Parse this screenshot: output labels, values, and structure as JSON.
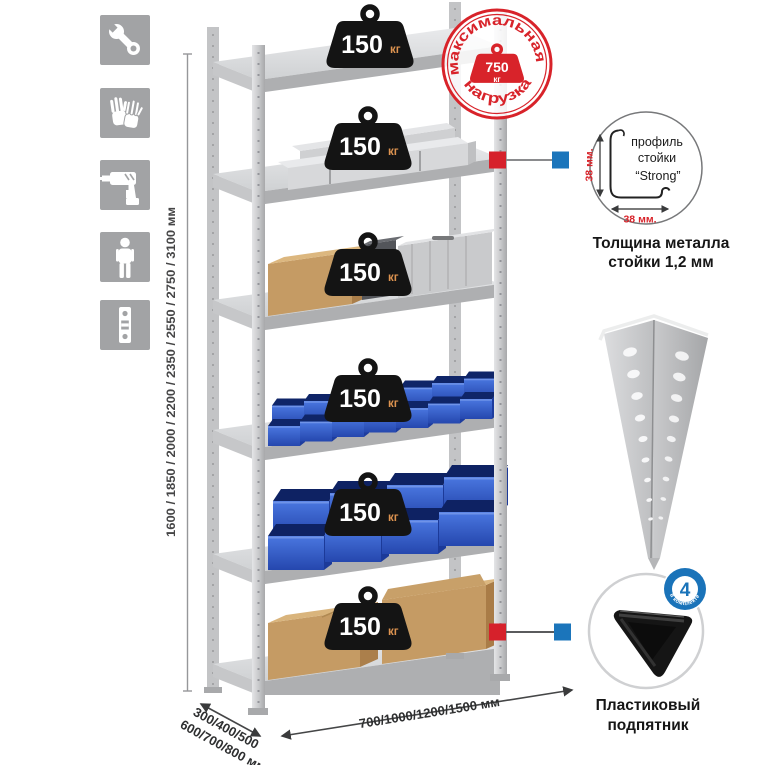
{
  "palette": {
    "accent_red": "#d8232a",
    "accent_blue": "#1b75bb",
    "bin_blue": "#3e6bd6",
    "metal_gray": "#cbccce",
    "weight_black": "#141414",
    "icon_tile_gray": "#a2a3a5",
    "cardboard": "#c59b64"
  },
  "feature_icons": [
    "wrench-icon",
    "gloves-icon",
    "drill-icon",
    "person-icon",
    "level-icon"
  ],
  "dimensions": {
    "height": "1600 / 1850 / 2000 / 2200 / 2350 / 2550 / 2750 / 3100 мм",
    "depth_line1": "300/400/500",
    "depth_line2": "600/700/800 мм",
    "width": "700/1000/1200/1500 мм"
  },
  "rack": {
    "shelf_count": 6,
    "shelf_load": {
      "value": "150",
      "unit": "кг"
    }
  },
  "stamp": {
    "arc_top": "максимальная",
    "arc_bottom": "нагрузка",
    "value": "750",
    "unit": "кг"
  },
  "profile": {
    "line1": "профиль",
    "line2": "стойки",
    "line3": "“Strong”",
    "dim_v": "38 мм.",
    "dim_h": "38 мм.",
    "caption1": "Толщина металла",
    "caption2": "стойки 1,2 мм"
  },
  "foot": {
    "badge": "4",
    "badge_arc": "в комплекте",
    "caption1": "Пластиковый",
    "caption2": "подпятник"
  }
}
